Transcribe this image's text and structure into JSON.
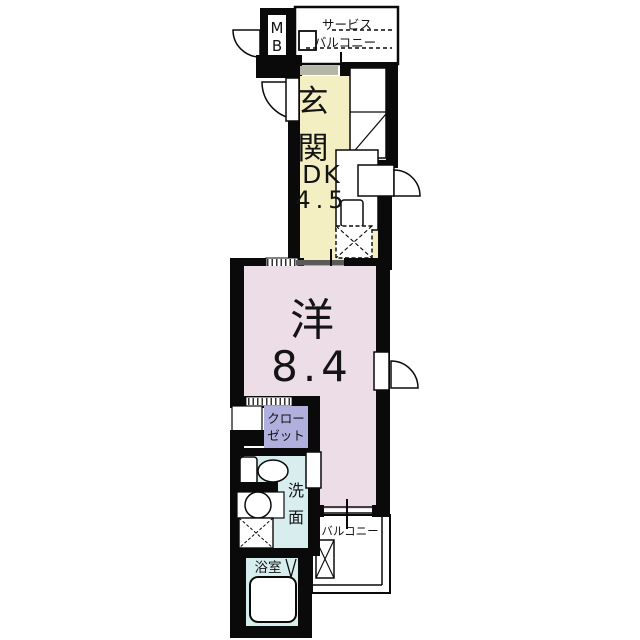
{
  "plan": {
    "type": "japanese-apartment-floor-plan",
    "colors": {
      "wall": "#0a0a0a",
      "entrance_dk": "#f4efc3",
      "western_room": "#eddde7",
      "closet": "#b1afdd",
      "wet_area": "#d8eeee",
      "bathroom": "#d8eeee",
      "sill_gray": "#b5b5a8",
      "slide_panel": "#5a5a5a"
    },
    "rooms": {
      "mb": {
        "label": "MB",
        "chars": [
          "M",
          "B"
        ]
      },
      "service_balcony": {
        "label": "サービスバルコニー",
        "lines": [
          "サービス",
          "バルコニー"
        ]
      },
      "entrance": {
        "label": "玄関",
        "chars": [
          "玄",
          "関"
        ]
      },
      "dk": {
        "label": "DK 4.5",
        "name": "DK",
        "area": "4.5",
        "lines": [
          "DK",
          "4.5"
        ]
      },
      "western_room": {
        "label": "洋 8.4",
        "name": "洋",
        "area": "8.4",
        "lines": [
          "洋",
          "8.4"
        ]
      },
      "closet": {
        "label": "クローゼット",
        "lines": [
          "クロー",
          "ゼット"
        ]
      },
      "washroom": {
        "label": "洗面",
        "chars": [
          "洗",
          "面"
        ]
      },
      "bathroom": {
        "label": "浴室"
      },
      "balcony": {
        "label": "バルコニー"
      }
    }
  }
}
